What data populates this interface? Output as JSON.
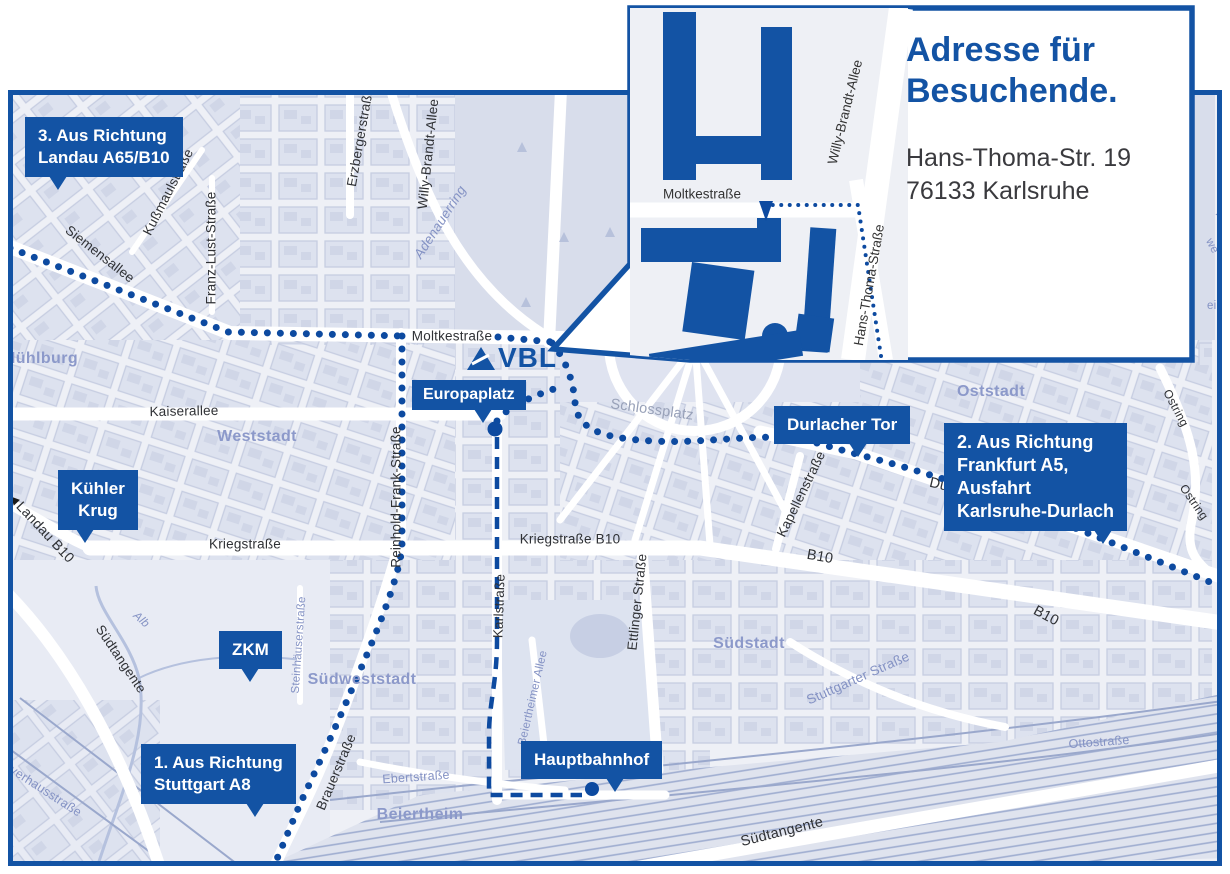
{
  "colors": {
    "brand_blue": "#1353a4",
    "route_blue": "#0d4aa0",
    "map_bg": "#eef0f6",
    "block_fill": "#dde2ef",
    "block_stroke": "#c6cde1",
    "place_label": "#8c99ca",
    "street_label": "#2f3135"
  },
  "logo": {
    "text": "VBL"
  },
  "icons": {
    "direction_arrow": "◀"
  },
  "inset": {
    "title_line1": "Adresse für",
    "title_line2": "Besuchende.",
    "address_line1": "Hans-Thoma-Str. 19",
    "address_line2": "76133 Karlsruhe",
    "streets": {
      "moltkestrasse": "Moltkestraße",
      "willy_brandt": "Willy-Brandt-Allee",
      "hans_thoma": "Hans-Thoma-Straße"
    }
  },
  "badges": {
    "route3": "3. Aus Richtung\nLandau A65/B10",
    "route2": "2. Aus Richtung\nFrankfurt A5,\nAusfahrt\nKarlsruhe-Durlach",
    "route1": "1. Aus Richtung\nStuttgart A8",
    "durlacher_tor": "Durlacher Tor",
    "europaplatz": "Europaplatz",
    "hauptbahnhof": "Hauptbahnhof",
    "kuehler_krug": "Kühler\nKrug",
    "zkm": "ZKM"
  },
  "districts": {
    "muehlburg": "Mühlburg",
    "weststadt": "Weststadt",
    "oststadt": "Oststadt",
    "suedstadt": "Südstadt",
    "suedweststadt": "Südweststadt",
    "beiertheim": "Beiertheim"
  },
  "streets": {
    "siemensallee": "Siemensallee",
    "kussmaulstrasse": "Kußmaulstraße",
    "franz_lust": "Franz-Lust-Straße",
    "erzbergerstrasse": "Erzbergerstraße",
    "adenauerring": "Adenauerring",
    "willy_brandt": "Willy-Brandt-Allee",
    "moltkestrasse": "Moltkestraße",
    "kaiserallee": "Kaiserallee",
    "reinhold_frank": "Reinhold-Frank-Straße",
    "kriegstrasse": "Kriegstraße",
    "kriegstrasse_b10": "Kriegstraße B10",
    "karlstrasse": "Karlstraße",
    "ettlinger": "Ettlinger Straße",
    "beiertheimer_allee": "Beiertheimer Allee",
    "schlossplatz": "Schlossplatz",
    "kapellenstrasse": "Kapellenstraße",
    "durlacher_allee": "Durlacher Allee",
    "b10": "B10",
    "stuttgarter": "Stuttgarter Straße",
    "suedtangente": "Südtangente",
    "brauerstrasse": "Brauerstraße",
    "ebertstrasse": "Ebertstraße",
    "steinhaeuserstrasse": "Steinhäuserstraße",
    "ottostrasse": "Ottostraße",
    "pulverhausstrasse": "Pulverhausstraße",
    "landau_b10": "Landau B10",
    "alb": "Alb",
    "ostring": "Ostring",
    "edge_fragment_1": "Hai",
    "edge_fragment_2": "we",
    "edge_fragment_3": "ein"
  }
}
